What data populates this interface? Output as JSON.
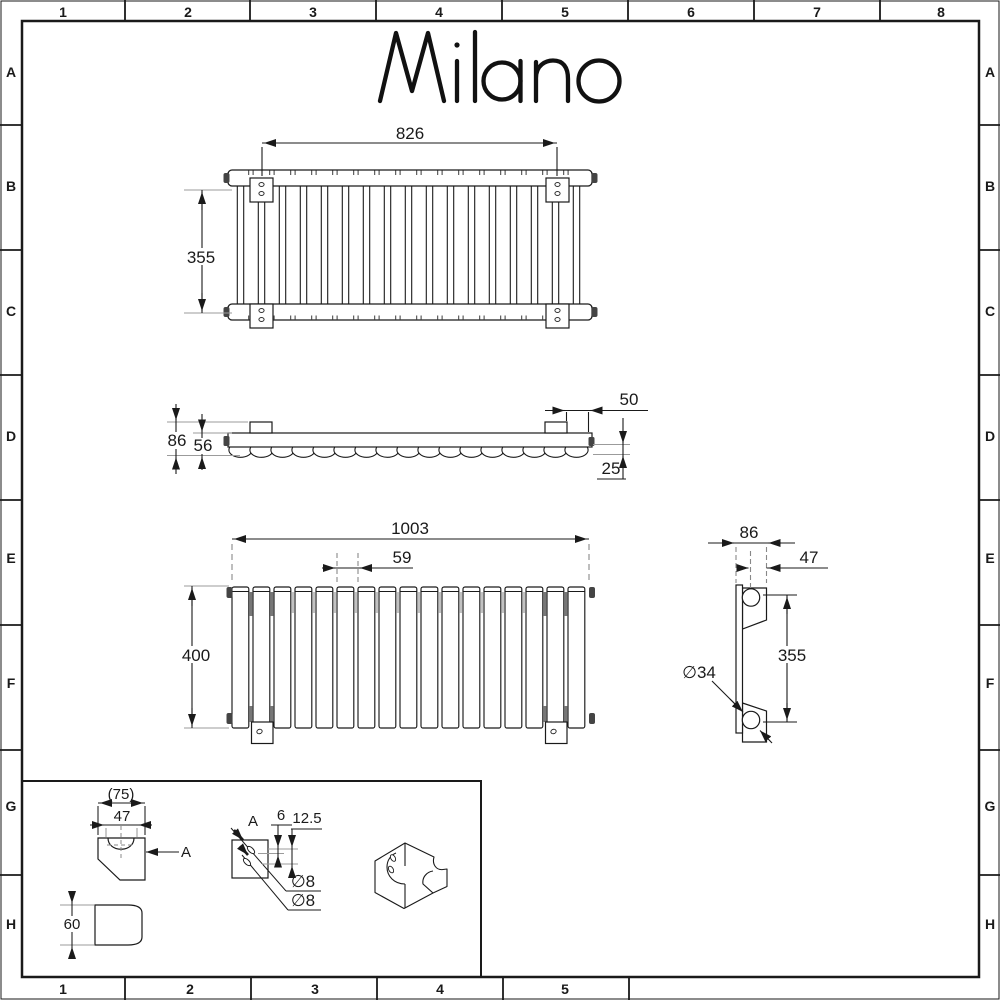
{
  "logo": "Milano",
  "grid": {
    "top": [
      "1",
      "2",
      "3",
      "4",
      "5",
      "6",
      "7",
      "8"
    ],
    "bottom": [
      "1",
      "2",
      "3",
      "4",
      "5"
    ],
    "left": [
      "A",
      "B",
      "C",
      "D",
      "E",
      "F",
      "G",
      "H"
    ],
    "right": [
      "A",
      "B",
      "C",
      "D",
      "E",
      "F",
      "G",
      "H"
    ]
  },
  "dimensions": {
    "plan": {
      "width": "826",
      "depth": "355"
    },
    "side": {
      "overall_depth": "86",
      "panel_depth": "56",
      "bracket_inset": "50",
      "wall_clearance": "25"
    },
    "front": {
      "overall_width": "1003",
      "panel_pitch": "59",
      "height": "400"
    },
    "end": {
      "overall_depth": "86",
      "bracket_projection": "47",
      "fixing_centres": "355",
      "tube_diameter": "∅34"
    },
    "bracket": {
      "overall_width": "(75)",
      "notch_offset": "47",
      "section_arrow": "A",
      "height": "60",
      "section_label": "A",
      "hole_spacing": "6",
      "hole_offset": "12.5",
      "hole_dia_1": "∅8",
      "hole_dia_2": "∅8"
    }
  },
  "colors": {
    "line": "#1a1a1a",
    "extension": "#9b9b9b",
    "background": "#ffffff"
  }
}
